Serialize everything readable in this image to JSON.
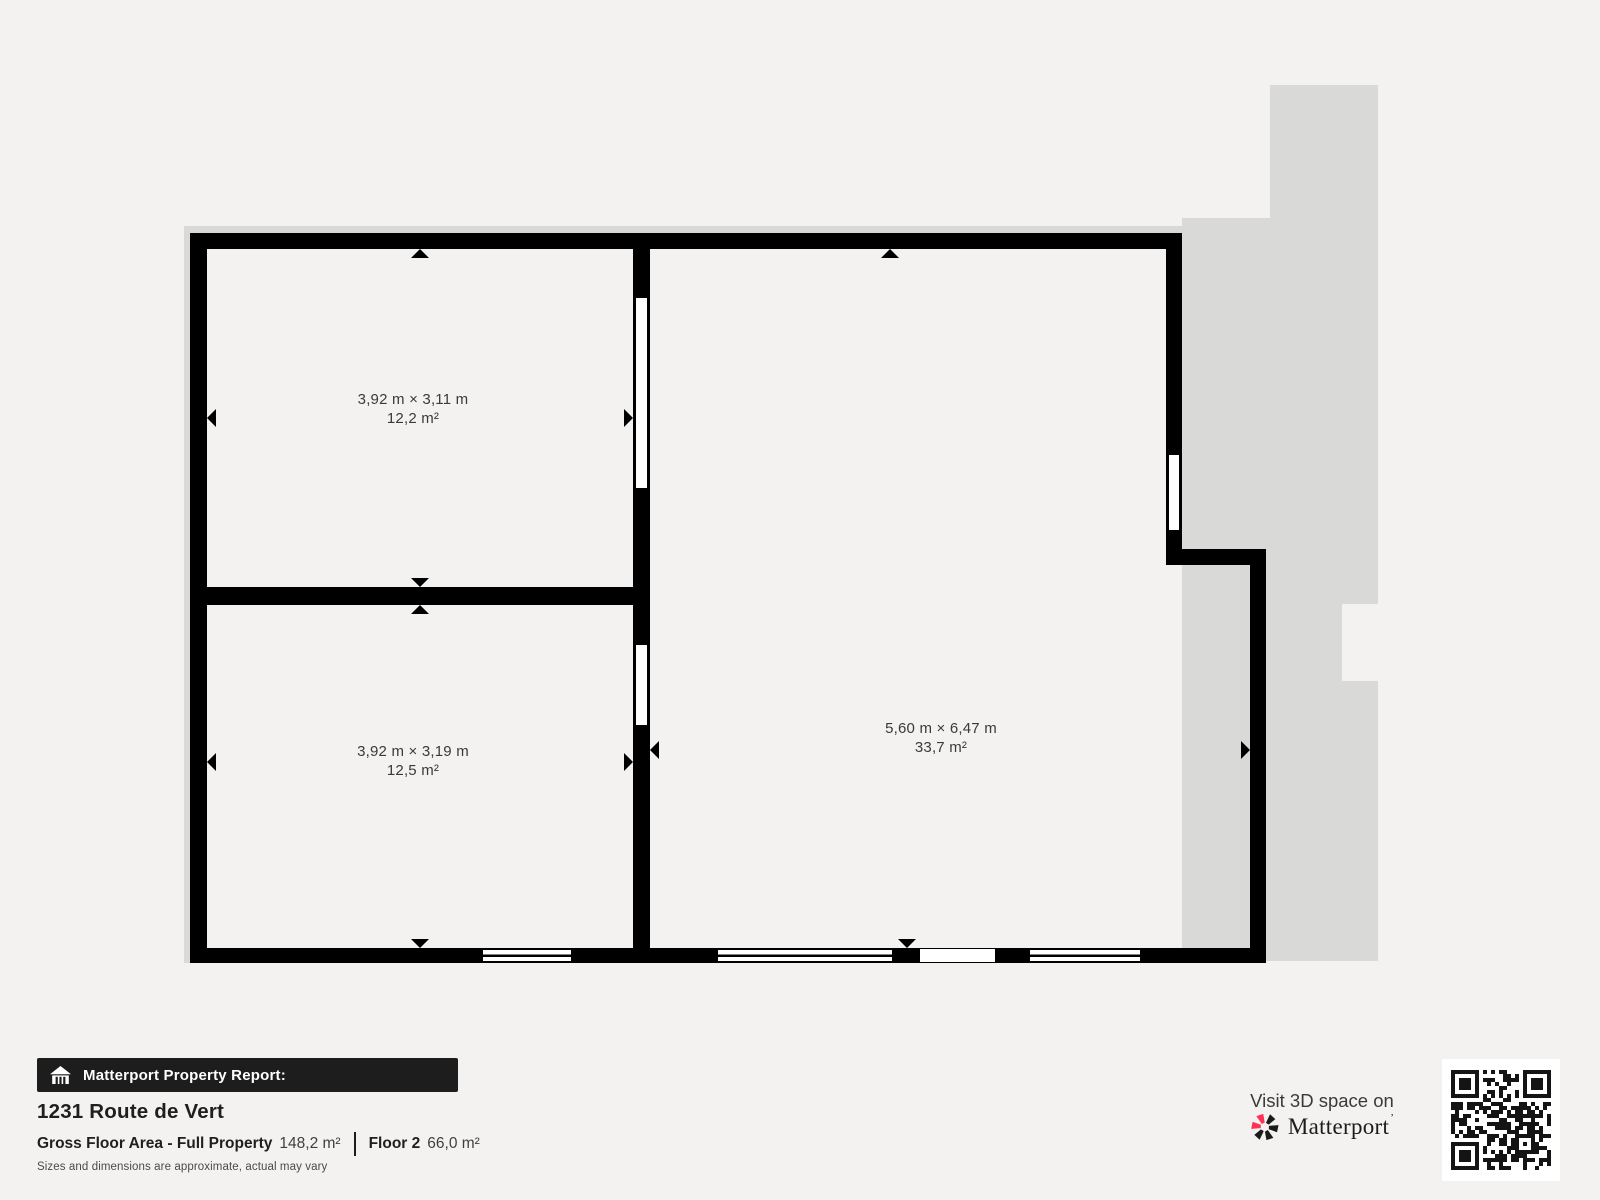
{
  "colors": {
    "background": "#f3f2f0",
    "silhouette": "#d9d9d8",
    "wall": "#000000",
    "room_fill": "#ffffff",
    "banner_bg": "#1d1d1d",
    "brand_red": "#ff3158",
    "heading_text": "#1f1f1f",
    "body_text": "#3a3a3a"
  },
  "floorplan": {
    "rooms": [
      {
        "id": "room-top-left",
        "dimensions": "3,92 m × 3,11 m",
        "area": "12,2 m²"
      },
      {
        "id": "room-bottom-left",
        "dimensions": "3,92 m × 3,19 m",
        "area": "12,5 m²"
      },
      {
        "id": "room-right",
        "dimensions": "5,60 m × 6,47 m",
        "area": "33,7 m²"
      }
    ]
  },
  "report": {
    "banner": "Matterport Property Report:",
    "address": "1231 Route de Vert",
    "gross_label": "Gross Floor Area - Full Property",
    "gross_value": "148,2 m²",
    "floor_label": "Floor 2",
    "floor_value": "66,0 m²",
    "disclaimer": "Sizes and dimensions are approximate, actual may vary"
  },
  "promo": {
    "visit_text": "Visit 3D space on",
    "brand": "Matterport",
    "trademark": "’"
  },
  "icons": {
    "banner": "home-icon",
    "brand": "matterport-pinwheel-icon",
    "scan": "qr-code"
  }
}
